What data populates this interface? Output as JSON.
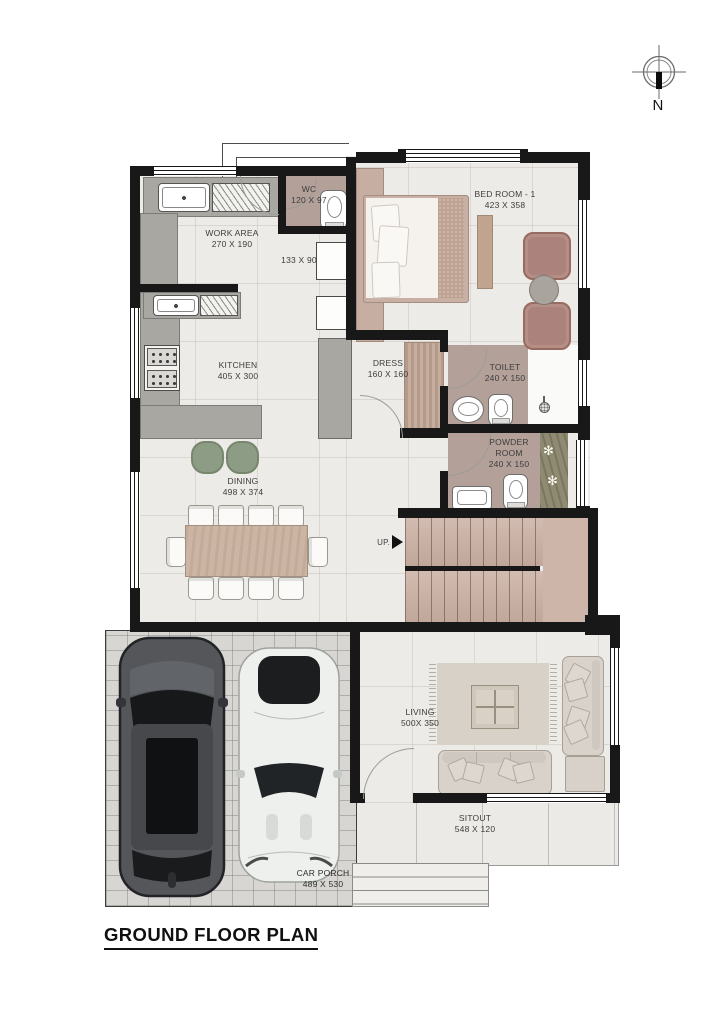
{
  "title": "GROUND FLOOR PLAN",
  "compass": {
    "label": "N"
  },
  "rooms": {
    "wc": {
      "name": "WC",
      "dims": "120 X 97"
    },
    "bedroom1": {
      "name": "BED ROOM - 1",
      "dims": "423 X 358"
    },
    "work_area": {
      "name": "WORK AREA",
      "dims": "270 X 190"
    },
    "passage": {
      "dims": "133 X 90"
    },
    "kitchen": {
      "name": "KITCHEN",
      "dims": "405 X 300"
    },
    "dress": {
      "name": "DRESS",
      "dims": "160 X 160"
    },
    "toilet": {
      "name": "TOILET",
      "dims": "240 X 150"
    },
    "powder_room": {
      "name": "POWDER ROOM",
      "dims": "240 X 150"
    },
    "dining": {
      "name": "DINING",
      "dims": "498 X 374"
    },
    "living": {
      "name": "LIVING",
      "dims": "500X 350"
    },
    "sitout": {
      "name": "SITOUT",
      "dims": "548 X 120"
    },
    "car_porch": {
      "name": "CAR PORCH",
      "dims": "489 X 530"
    }
  },
  "stairs": {
    "direction_label": "UP."
  },
  "colors": {
    "wall": "#181818",
    "floor": "#edebe7",
    "wet_room_floor": "#b3a099",
    "counter_grey": "#a9a7a1",
    "stair_tan": "#c9b1a6",
    "wood_tan": "#ccb5a5",
    "pouf_green": "#8d9c85",
    "bedroom_chair_mauve": "#b58e86",
    "sofa_beige": "#d9d2cb",
    "car_porch_grey": "#d8d6d2"
  }
}
